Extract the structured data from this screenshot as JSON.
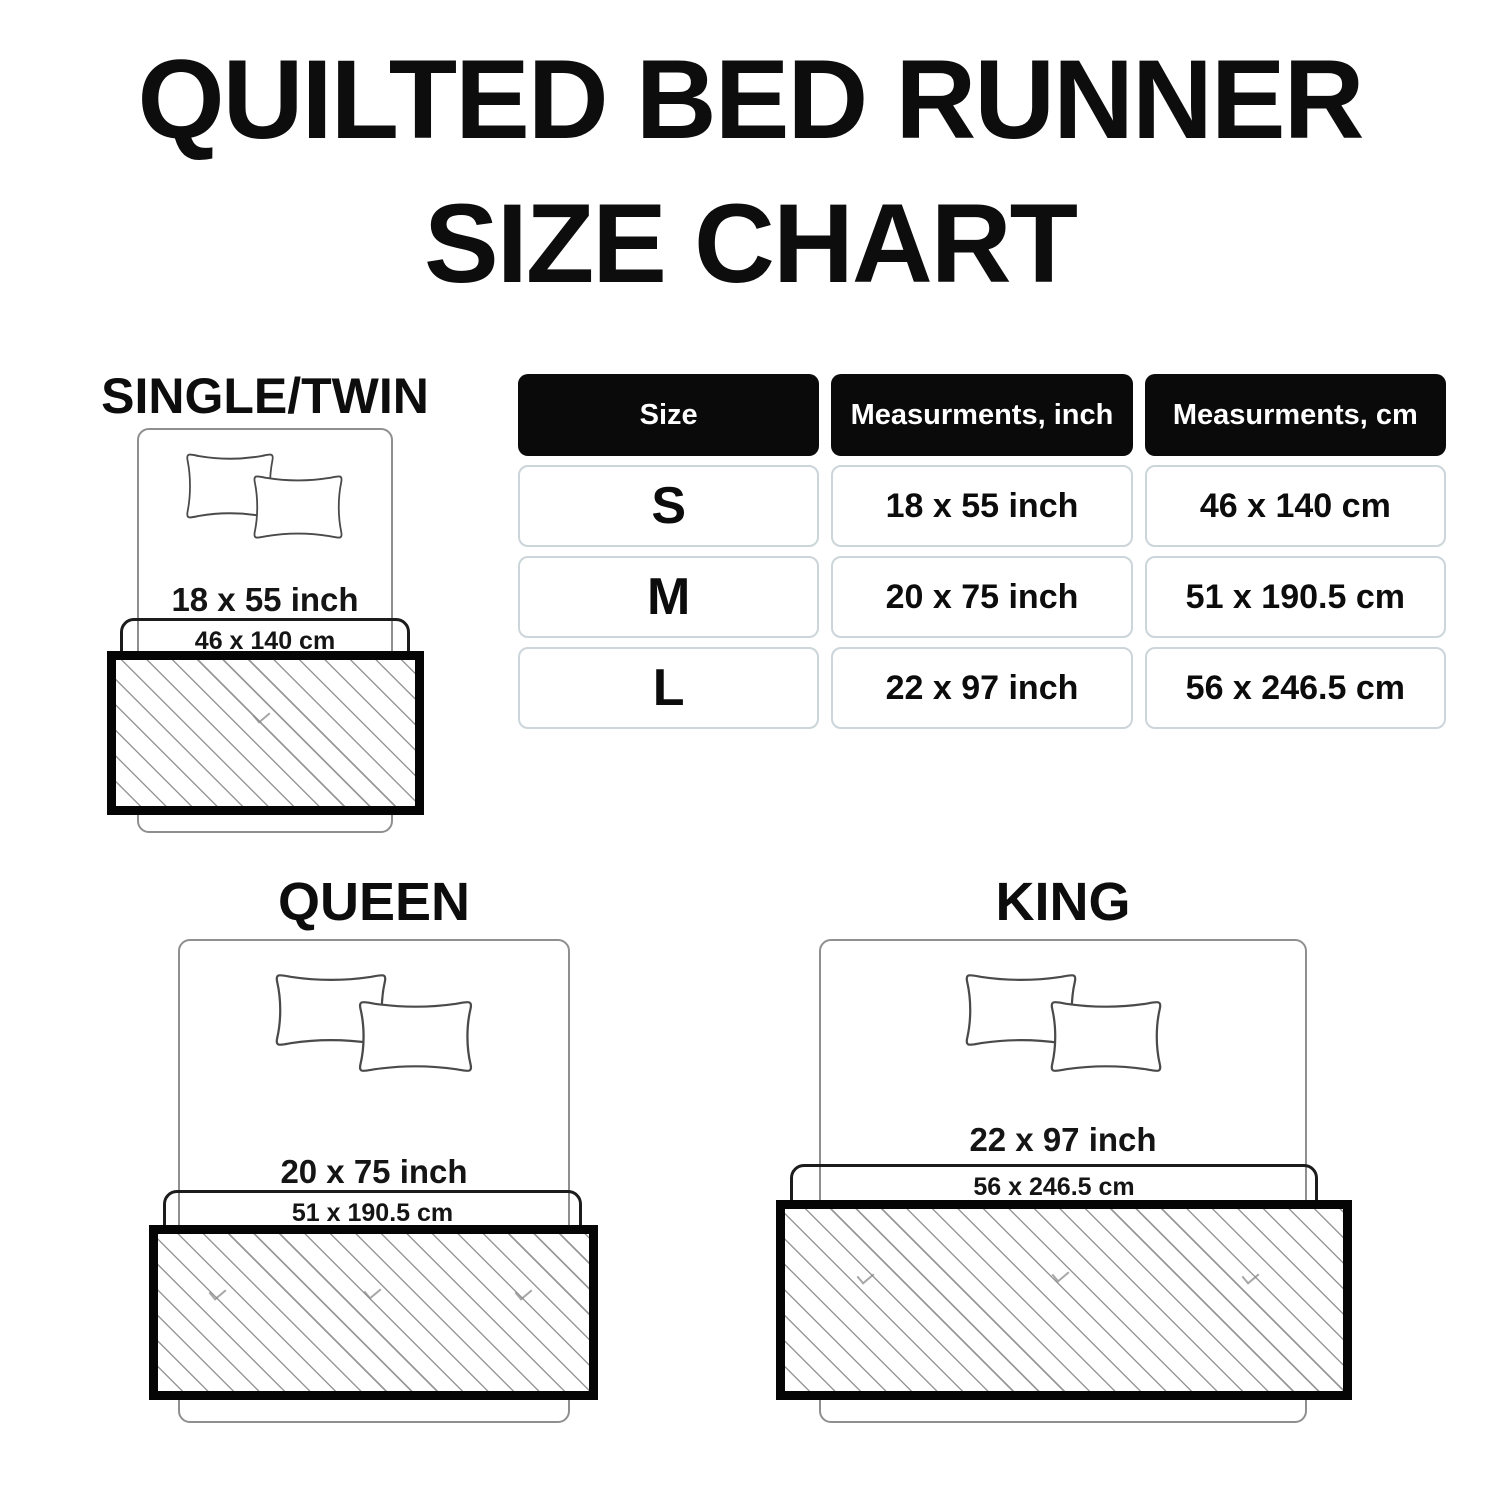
{
  "title": {
    "line1": "QUILTED BED RUNNER",
    "line2": "SIZE CHART"
  },
  "table": {
    "headers": [
      "Size",
      "Measurments, inch",
      "Measurments, cm"
    ],
    "rows": [
      {
        "size": "S",
        "inch": "18 x 55 inch",
        "cm": "46 x 140 cm"
      },
      {
        "size": "M",
        "inch": "20 x 75 inch",
        "cm": "51 x 190.5 cm"
      },
      {
        "size": "L",
        "inch": "22 x 97 inch",
        "cm": "56 x 246.5 cm"
      }
    ]
  },
  "diagrams": [
    {
      "label": "SINGLE/TWIN",
      "inch": "18 x 55 inch",
      "cm": "46 x 140 cm"
    },
    {
      "label": "QUEEN",
      "inch": "20 x 75 inch",
      "cm": "51 x 190.5 cm"
    },
    {
      "label": "KING",
      "inch": "22 x 97 inch",
      "cm": "56 x 246.5 cm"
    }
  ],
  "colors": {
    "title_text": "#0d0d0d",
    "header_bg": "#0a0a0a",
    "header_text": "#ffffff",
    "cell_border": "#ccd5d9",
    "body_text": "#111111",
    "bed_outline": "#8f8f8f",
    "pillow_outline": "#4a4a4a",
    "runner_border": "#050505",
    "hatch_line": "#999999",
    "cm_box_border": "#1c1c1c"
  }
}
